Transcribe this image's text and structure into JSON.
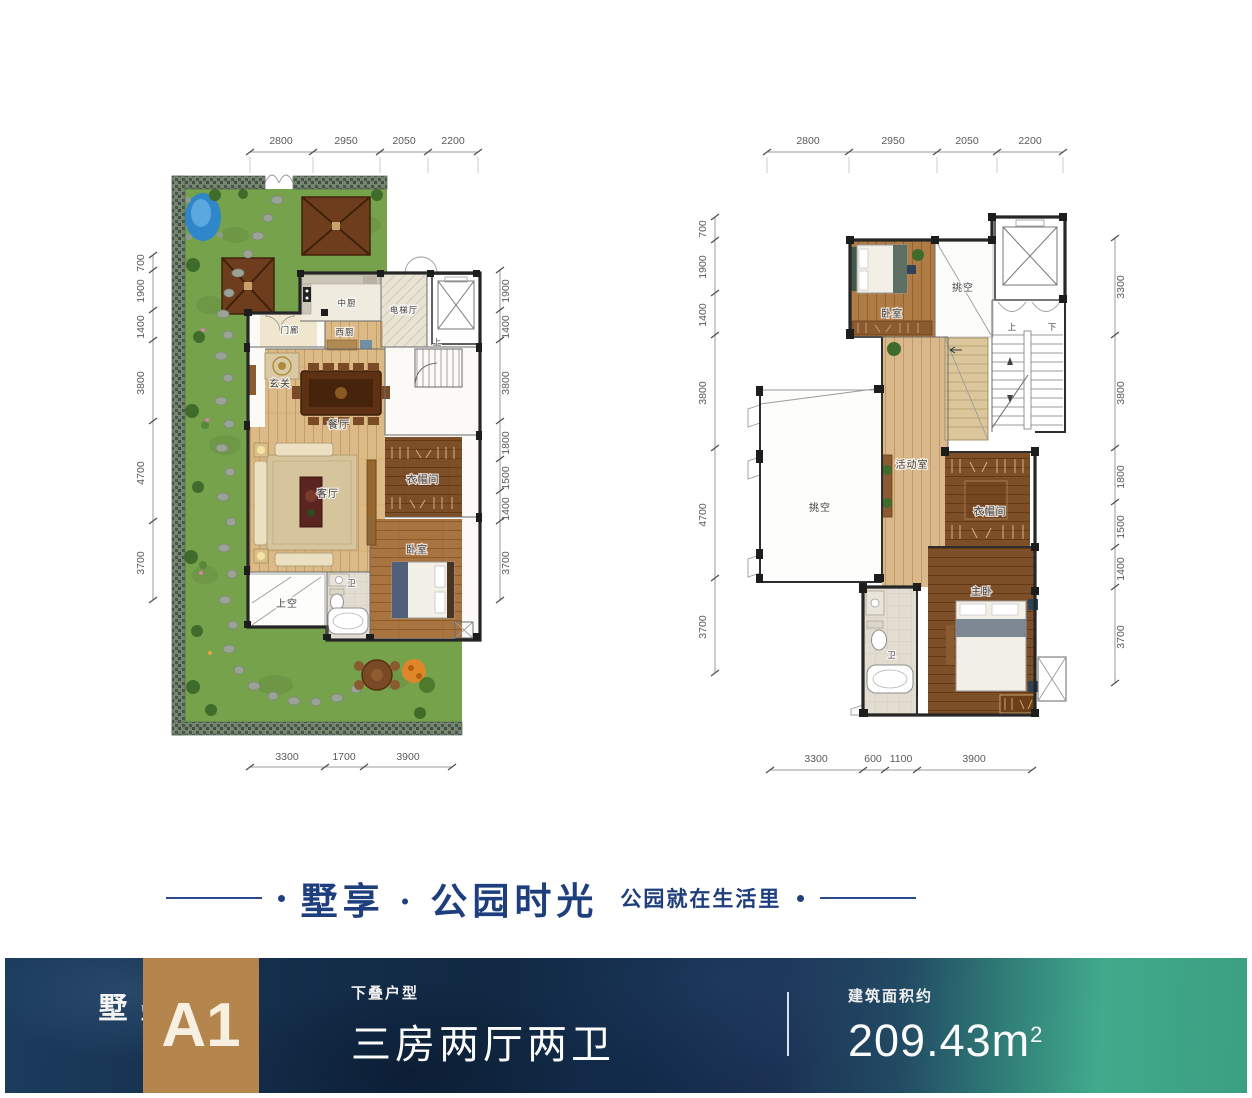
{
  "slogan": {
    "main": "墅享 · 公园时光",
    "sub": "公园就在生活里"
  },
  "banner": {
    "series_vertical": "叠墅",
    "unit_code": "A1",
    "type_label": "下叠户型",
    "type_value": "三房两厅两卫",
    "area_label": "建筑面积约",
    "area_value": "209.43m",
    "area_sup": "2",
    "colors": {
      "navy": "#14304e",
      "teal": "#41aa8b",
      "brown": "#b5854e",
      "slogan_blue": "#1e3e7e"
    }
  },
  "plans": [
    {
      "name": "lower-unit-floor-plan",
      "dims_top": [
        "2800",
        "2950",
        "2050",
        "2200"
      ],
      "dims_left": [
        "700",
        "1900",
        "1400",
        "3800",
        "4700",
        "3700"
      ],
      "dims_right": [
        "1900",
        "1400",
        "3800",
        "1800",
        "1500",
        "1400",
        "3700"
      ],
      "dims_bottom": [
        "3300",
        "1700",
        "3900"
      ],
      "rooms": {
        "kitchen_mid": "中厨",
        "elevator_hall": "电梯厅",
        "porch": "门廊",
        "kitchen_west": "西厨",
        "foyer": "玄关",
        "dining": "餐厅",
        "living": "客厅",
        "cloak": "衣帽间",
        "bedroom": "卧室",
        "bath": "卫",
        "void_above": "上空",
        "stair_up": "上"
      }
    },
    {
      "name": "upper-unit-floor-plan",
      "dims_top": [
        "2800",
        "2950",
        "2050",
        "2200"
      ],
      "dims_left": [
        "700",
        "1900",
        "1400",
        "3800",
        "4700",
        "3700"
      ],
      "dims_right": [
        "3300",
        "3800",
        "1800",
        "1500",
        "1400",
        "3700"
      ],
      "dims_bottom": [
        "3300",
        "600",
        "1100",
        "3900"
      ],
      "rooms": {
        "bedroom": "卧室",
        "void_top": "挑空",
        "activity": "活动室",
        "void_left": "挑空",
        "cloak": "衣帽间",
        "master": "主卧",
        "bath": "卫",
        "stair_up": "上",
        "stair_down": "下"
      }
    }
  ]
}
